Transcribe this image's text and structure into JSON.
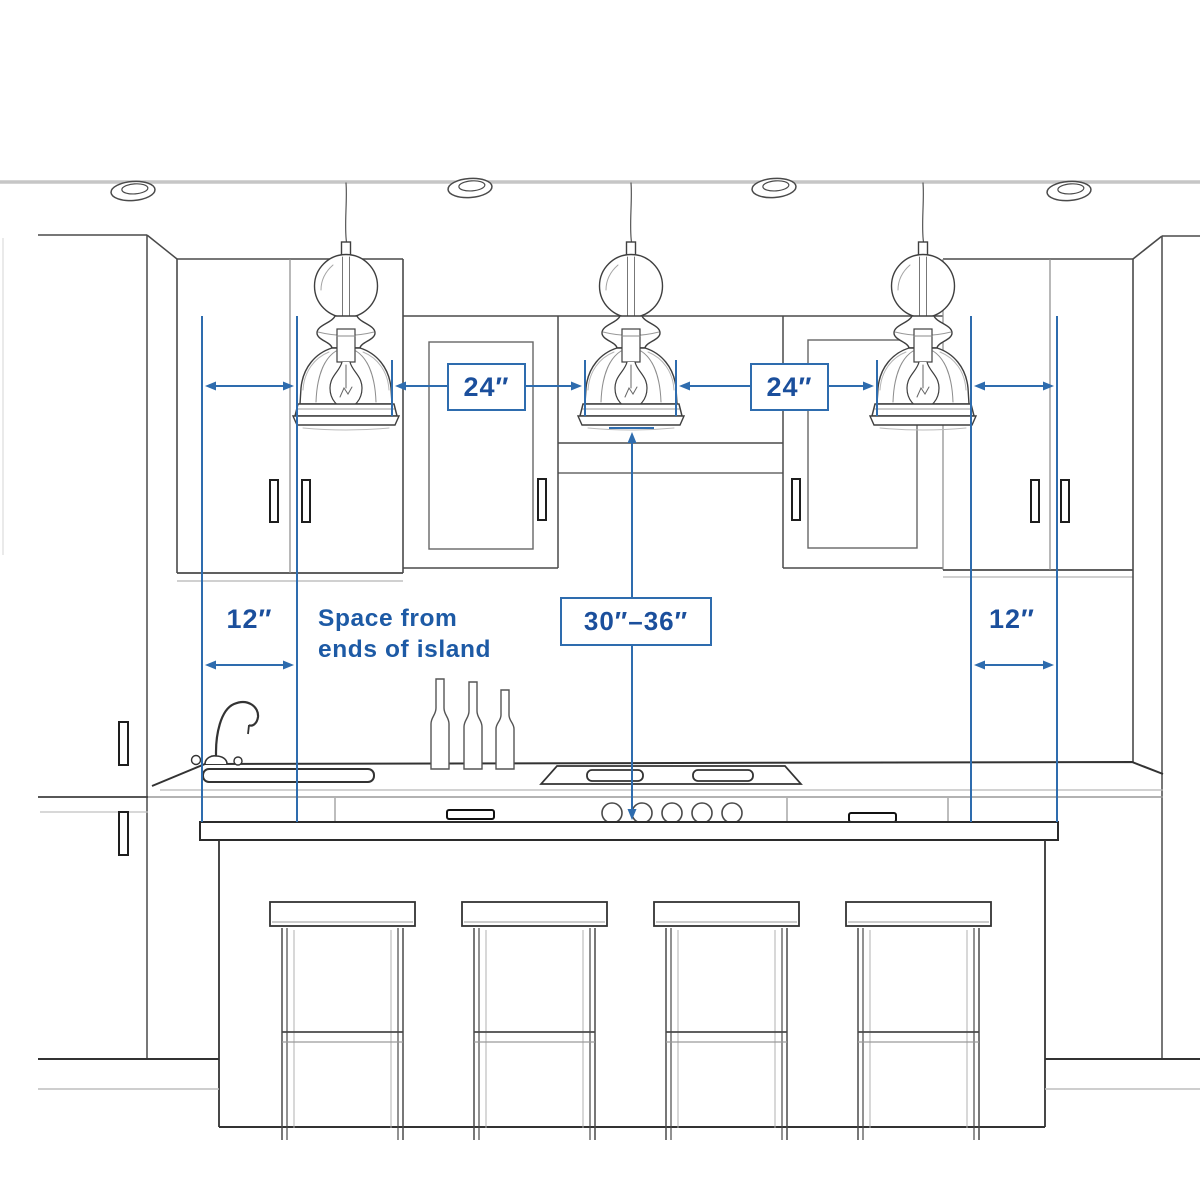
{
  "diagram": {
    "colors": {
      "dimension_line": "#2e6cae",
      "dimension_text": "#1b4f9c",
      "sketch_dark": "#3f3f3f",
      "sketch_light": "#b5b5b5"
    },
    "labels": {
      "pendant_gap_left": "24″",
      "pendant_gap_right": "24″",
      "island_end_gap_left": "12″",
      "island_end_gap_right": "12″",
      "hanging_height": "30″–36″"
    },
    "note": {
      "line1": "Space from",
      "line2": "ends of island"
    }
  }
}
